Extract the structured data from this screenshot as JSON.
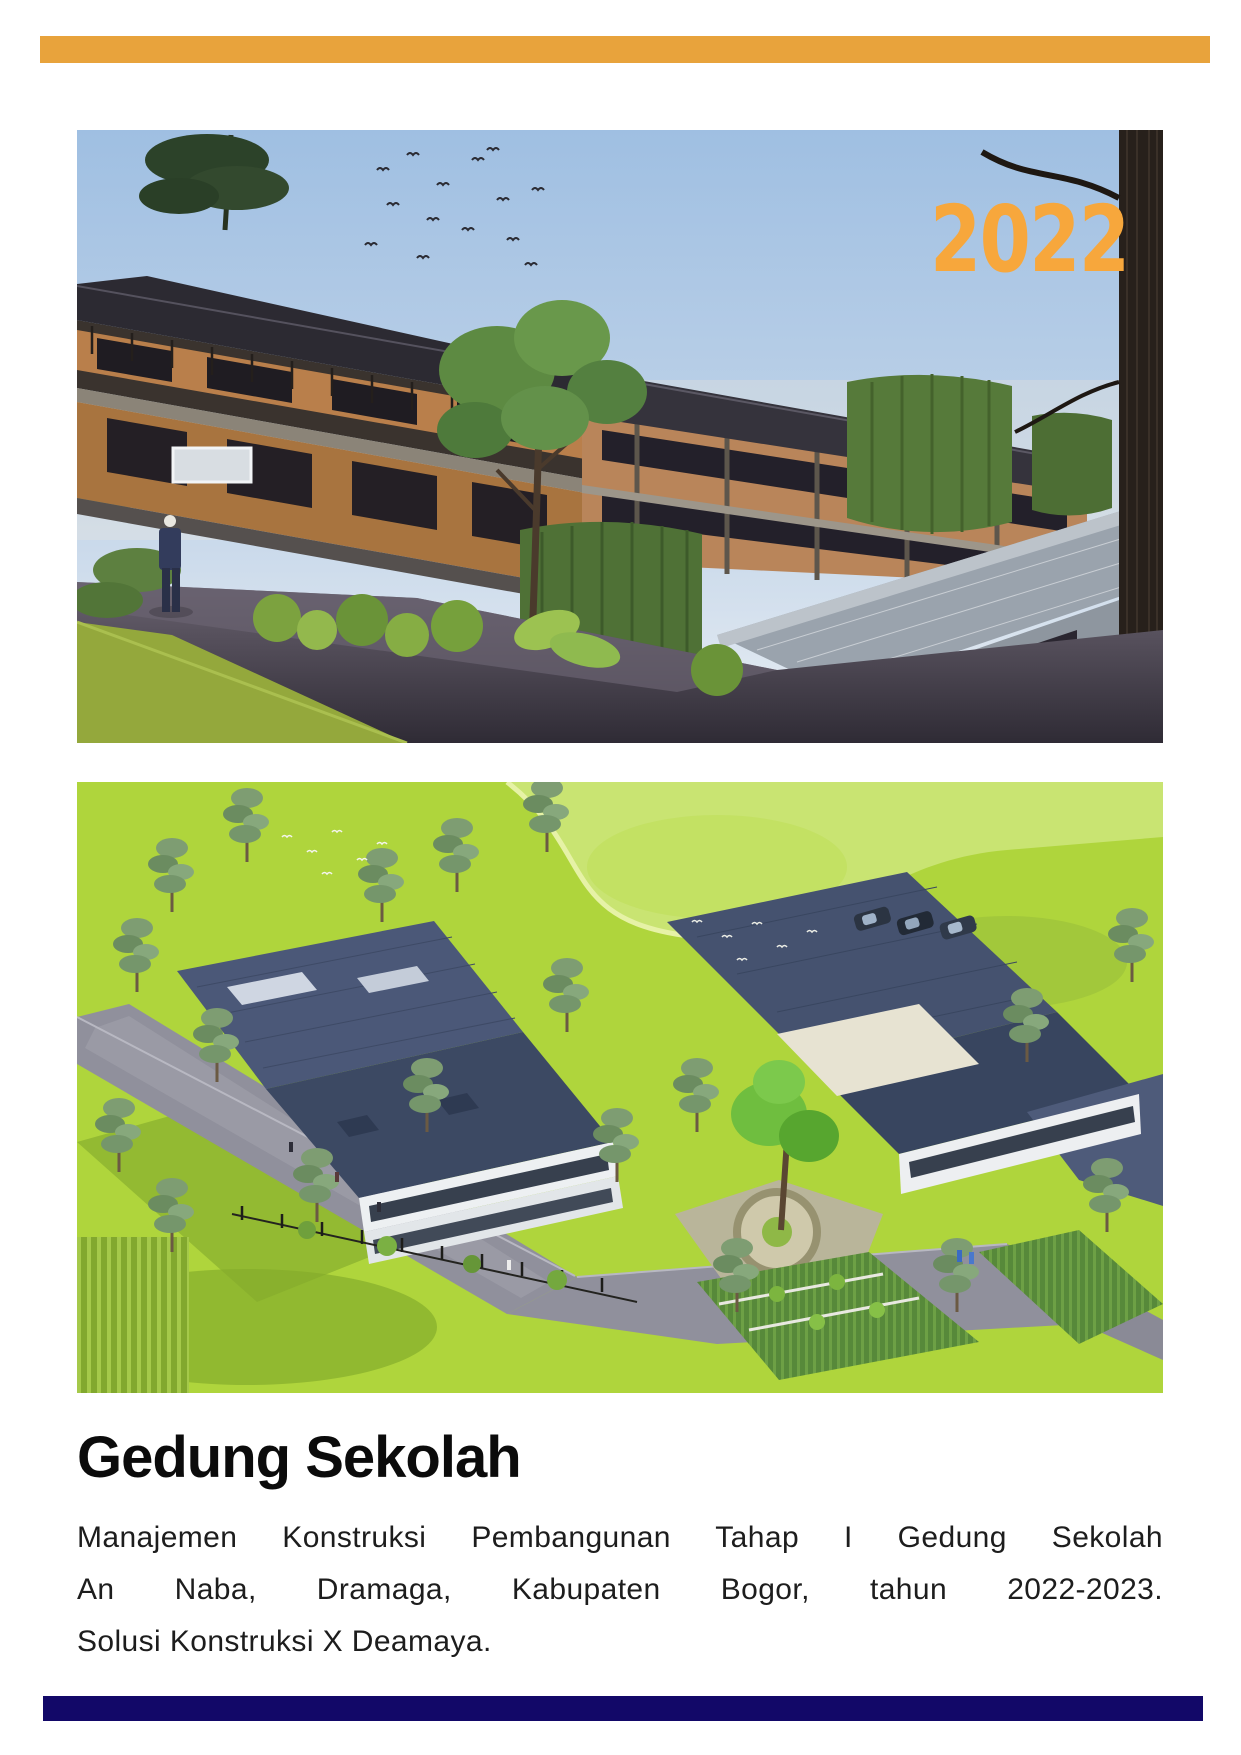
{
  "page": {
    "top_bar_color": "#E8A33C",
    "bottom_bar_color": "#120868"
  },
  "hero": {
    "year_overlay": "2022",
    "year_color": "#F7A73C"
  },
  "photos": {
    "photo_1": "exterior-street-level-render-of-school-building",
    "photo_2": "aerial-isometric-render-of-school-campus"
  },
  "project": {
    "title": "Gedung Sekolah",
    "description_lines": [
      "Manajemen Konstruksi Pembangunan Tahap I Gedung Sekolah",
      "An Naba, Dramaga, Kabupaten Bogor, tahun 2022-2023.",
      "Solusi Konstruksi X Deamaya."
    ]
  }
}
